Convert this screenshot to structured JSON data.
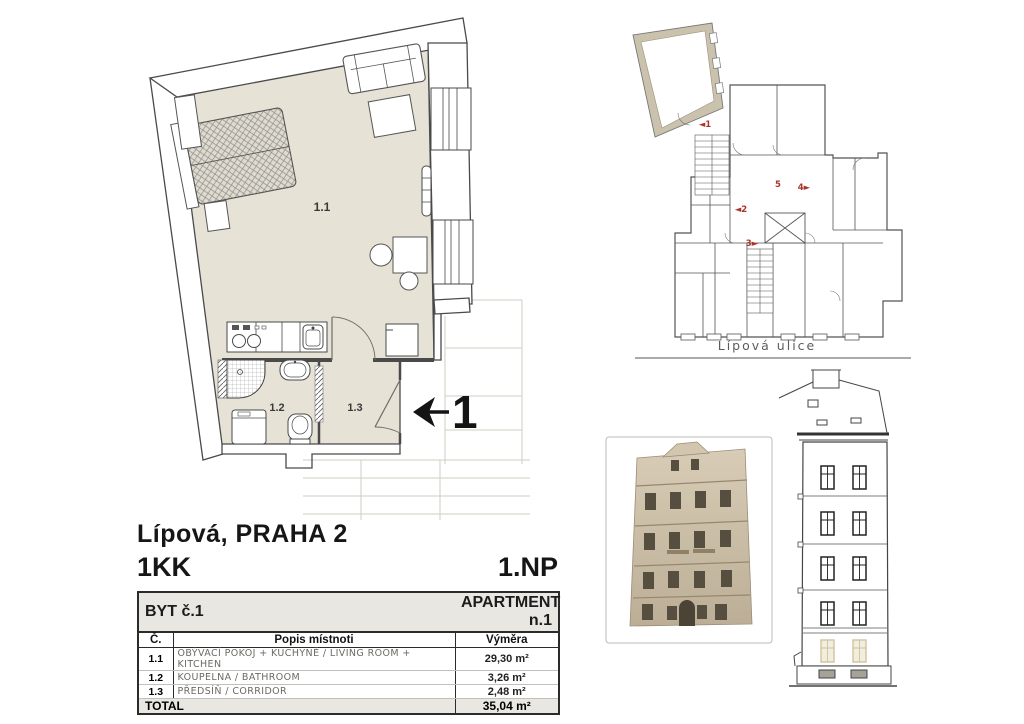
{
  "document": {
    "address": "Lípová, PRAHA 2",
    "unit_layout": "1KK",
    "floor": "1.NP"
  },
  "unit_table": {
    "title_left": "BYT č.1",
    "title_right": "APARTMENT n.1",
    "col_number": "Č.",
    "col_description": "Popis místnoti",
    "col_area": "Výměra",
    "rows": [
      {
        "num": "1.1",
        "desc": "OBÝVACÍ POKOJ + KUCHYNĚ / LIVING ROOM + KITCHEN",
        "area": "29,30 m²"
      },
      {
        "num": "1.2",
        "desc": "KOUPELNA / BATHROOM",
        "area": "3,26 m²"
      },
      {
        "num": "1.3",
        "desc": "PŘEDSÍŇ / CORRIDOR",
        "area": "2,48 m²"
      }
    ],
    "total_label": "TOTAL",
    "total_area": "35,04 m²"
  },
  "floor_plan": {
    "room_living": "1.1",
    "room_bathroom": "1.2",
    "room_corridor": "1.3",
    "entrance_number": "1"
  },
  "site_plan": {
    "street": "Lípová ulice",
    "marker_1": "◄1",
    "marker_2": "◄2",
    "marker_3": "3►",
    "marker_4": "4►",
    "marker_5": "5"
  },
  "colors": {
    "floor_fill": "#e7e2d6",
    "highlight_wall": "#cbc2ad",
    "marker_red": "#a8352c",
    "table_band_bg": "#e8e7e2"
  }
}
